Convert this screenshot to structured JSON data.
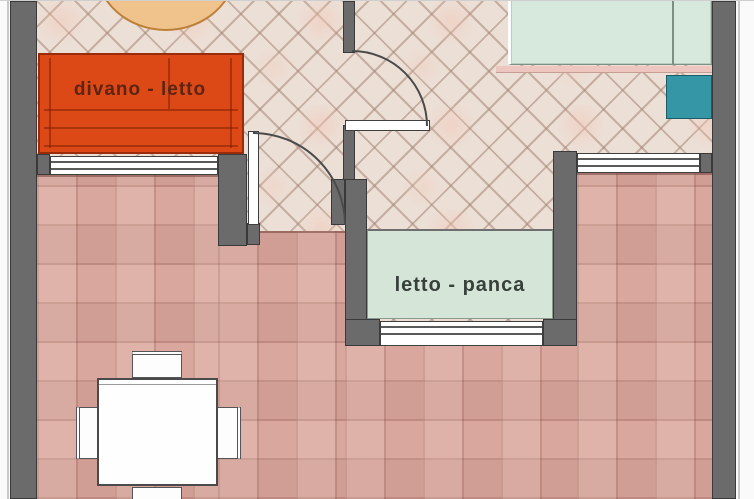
{
  "labels": {
    "sofa": "divano - letto",
    "bench": "letto - panca"
  },
  "colors": {
    "wall": "#6b6b6b",
    "wall-edge": "#3a3a3a",
    "diamond-floor": "#ecdfd6",
    "terrace-floor": "#d9a79e",
    "sofa": "#dc4917",
    "sofa-border": "#9a2c0c",
    "sofa-text": "#5e2410",
    "round-table": "#f0c38c",
    "round-table-border": "#bc8038",
    "bed": "#d7e8dc",
    "teal-box": "#3597a6",
    "bench": "#d5e6d8",
    "bench-text": "#38403c"
  }
}
